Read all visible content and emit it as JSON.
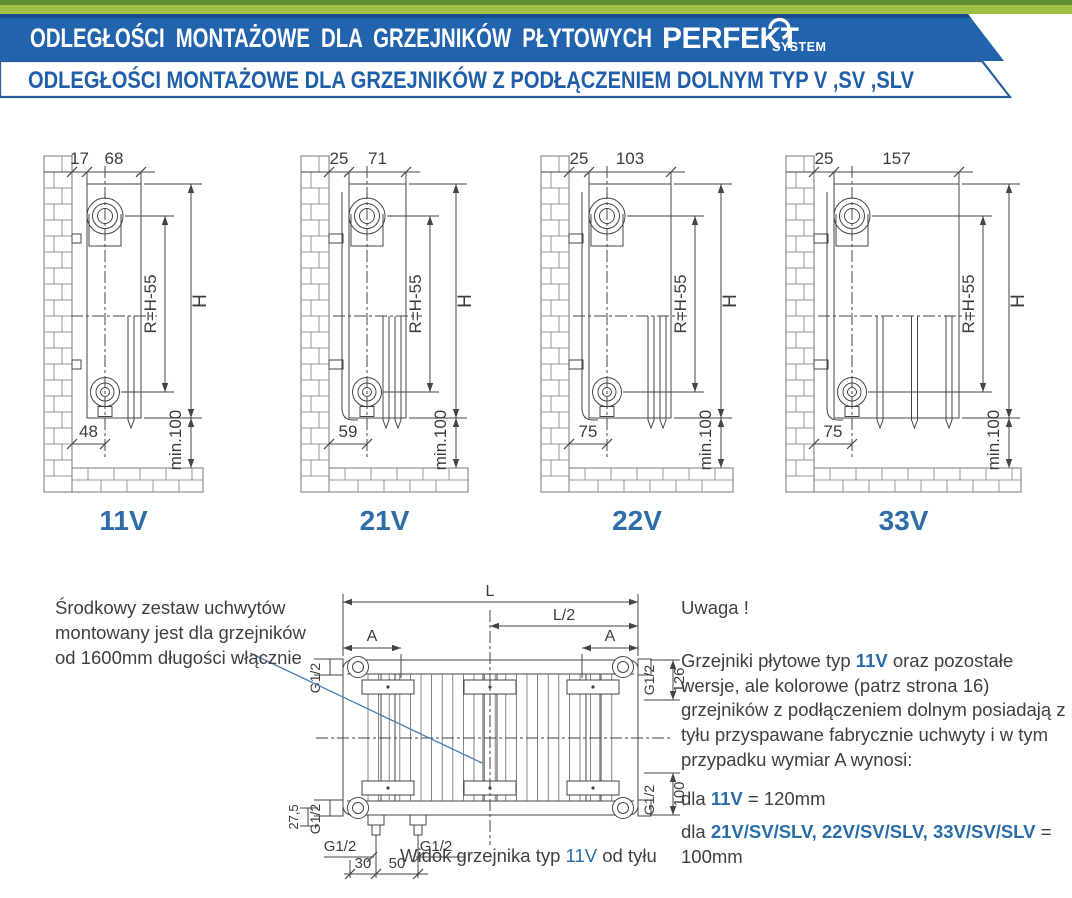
{
  "colors": {
    "banner_blue": "#2263AD",
    "banner_navy_edge": "#1A4B8C",
    "green_light": "#9DC045",
    "green_dark": "#5F8F2E",
    "outline_blue": "#2A5F9E",
    "text_blue": "#1F5FA9",
    "accent_blue": "#2E6DA8",
    "line": "#444444",
    "brick": "#999999"
  },
  "header": {
    "bar1": "ODLEGŁOŚCI MONTAŻOWE DLA GRZEJNIKÓW PŁYTOWYCH",
    "logo_main": "PERFEKT",
    "logo_sub": "SYSTEM",
    "bar2": "ODLEGŁOŚCI MONTAŻOWE DLA GRZEJNIKÓW Z PODŁĄCZENIEM DOLNYM TYP V ,SV ,SLV"
  },
  "diagrams": [
    {
      "type_label": "11V",
      "wall_gap": "17",
      "depth": "68",
      "bottom_offset": "48",
      "height": "H",
      "radius": "R=H-55",
      "min_clearance": "min.100"
    },
    {
      "type_label": "21V",
      "wall_gap": "25",
      "depth": "71",
      "bottom_offset": "59",
      "height": "H",
      "radius": "R=H-55",
      "min_clearance": "min.100"
    },
    {
      "type_label": "22V",
      "wall_gap": "25",
      "depth": "103",
      "bottom_offset": "75",
      "height": "H",
      "radius": "R=H-55",
      "min_clearance": "min.100"
    },
    {
      "type_label": "33V",
      "wall_gap": "25",
      "depth": "157",
      "bottom_offset": "75",
      "height": "H",
      "radius": "R=H-55",
      "min_clearance": "min.100"
    }
  ],
  "rear_view": {
    "length": "L",
    "half_length": "L/2",
    "bracket_dim": "A",
    "connection": "G1/2",
    "dim_top_right": "126",
    "dim_bottom_right": "100",
    "dim_left": "27,5",
    "dim_pipe_1": "30",
    "dim_pipe_2": "50",
    "caption_prefix": "Widok grzejnika typ ",
    "caption_type": "11V",
    "caption_suffix": " od tyłu"
  },
  "note_left": {
    "text": "Środkowy zestaw uchwytów\nmontowany jest dla grzejników\nod 1600mm długości włącznie"
  },
  "note_right": {
    "title": "Uwaga !",
    "para_1": "Grzejniki płytowe typ ",
    "para_highlight": "11V",
    "para_2": " oraz pozostałe wersje, ale kolorowe (patrz strona 16) grzejników z podłączeniem dolnym posiadają z tyłu przyspawane fabrycznie uchwyty i w tym przypadku wymiar A wynosi:",
    "line1_prefix": "dla ",
    "line1_highlight": "11V",
    "line1_suffix": " = 120mm",
    "line2_prefix": "dla ",
    "line2_highlight": "21V/SV/SLV, 22V/SV/SLV, 33V/SV/SLV",
    "line2_suffix": " = 100mm"
  }
}
